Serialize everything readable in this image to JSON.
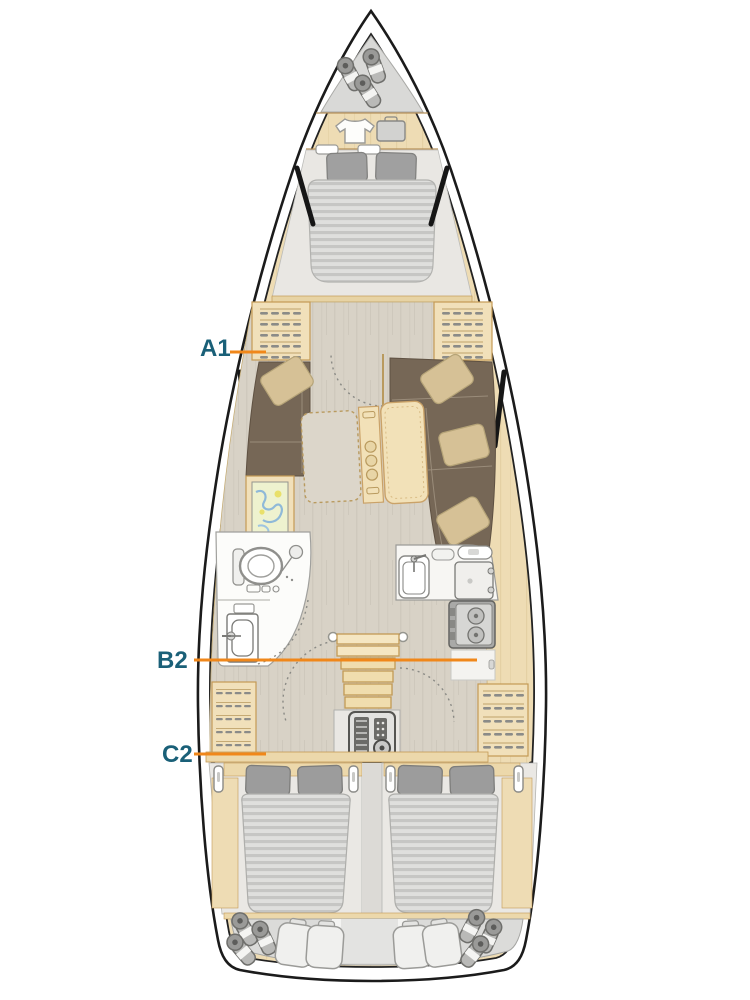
{
  "page": {
    "background": "#ffffff"
  },
  "plan": {
    "labels": {
      "a1": {
        "text": "A1"
      },
      "b2": {
        "text": "B2"
      },
      "c2": {
        "text": "C2"
      }
    },
    "colors": {
      "label_text": "#1a6078",
      "leader_line": "#f0871a",
      "hull_line": "#1b1b1b",
      "wood": "#eedcb4",
      "wood_edge": "#c49a55",
      "floor": "#d8d2c6",
      "upholstery": "#766756",
      "cushion": "#d6c196",
      "pillow": "#9c9c9c",
      "mattress_stripe": "#c6c6c4",
      "locker": "#dbdbd9"
    },
    "icons": {
      "bow_storage": [
        "fender-icon",
        "fender-icon",
        "fender-icon",
        "tshirt-icon",
        "suitcase-icon"
      ],
      "forward_cabin": [
        "double-bed-icon",
        "wardrobe-hanger-icon",
        "wardrobe-hanger-icon"
      ],
      "salon": [
        "sofa-icon",
        "l-sofa-icon",
        "folding-table-icon",
        "bottle-holder-icon",
        "chart-table-map-icon"
      ],
      "head": [
        "toilet-icon",
        "shower-icon",
        "sink-icon"
      ],
      "galley": [
        "sink-icon",
        "fridge-icon",
        "stove-icon"
      ],
      "companionway": [
        "stairs-icon",
        "engine-icon"
      ],
      "aft_cabins": [
        "double-bed-icon",
        "double-bed-icon",
        "wardrobe-hanger-icon",
        "wardrobe-hanger-icon"
      ],
      "stern_storage": [
        "fender-icon",
        "sail-bag-icon"
      ]
    }
  }
}
